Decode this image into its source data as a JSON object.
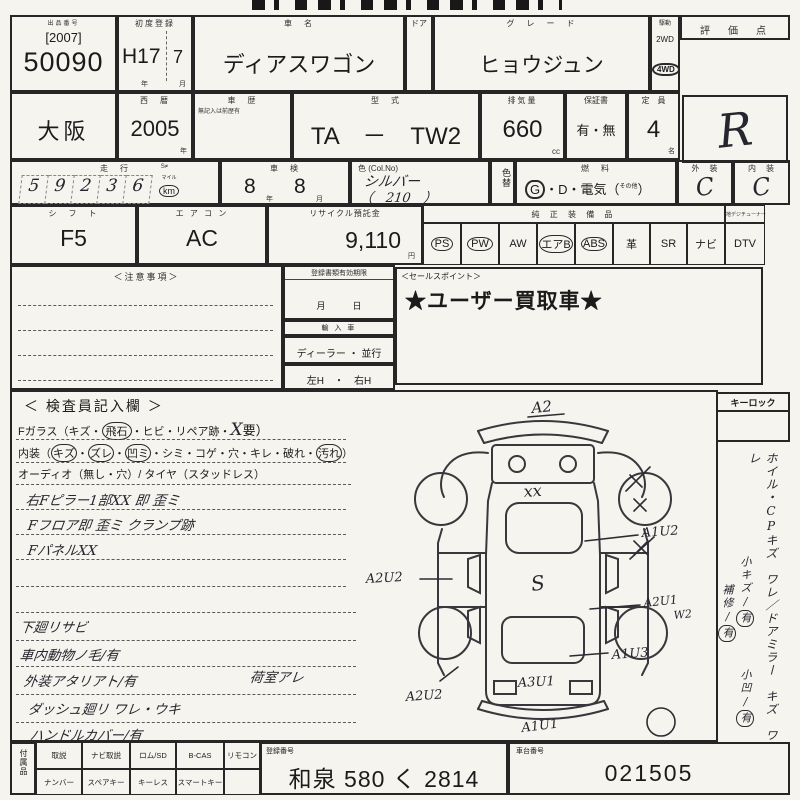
{
  "lot": {
    "label": "出品番号",
    "year": "[2007]",
    "number": "50090"
  },
  "first_reg": {
    "label": "初度登録",
    "year": "H17",
    "month": "7",
    "year_unit": "年",
    "month_unit": "月"
  },
  "car_name": {
    "label": "車　名",
    "value": "ディアスワゴン"
  },
  "door": {
    "label": "ドア"
  },
  "grade": {
    "label": "グ　レ　ー　ド",
    "value": "ヒョウジュン"
  },
  "drive": {
    "label": "駆動",
    "option1": "2WD",
    "option2": "4WD"
  },
  "score": {
    "label": "評　価　点",
    "value": "R"
  },
  "region": {
    "value": "大阪"
  },
  "west_year": {
    "label": "西　暦",
    "value": "2005",
    "unit": "年"
  },
  "history": {
    "label": "車　歴",
    "note": "無記入は前歴有"
  },
  "model": {
    "label": "型　式",
    "value": "TA　－　TW2"
  },
  "displacement": {
    "label": "排気量",
    "value": "660",
    "unit": "cc"
  },
  "warranty": {
    "label": "保証書",
    "value": "有・無"
  },
  "capacity": {
    "label": "定　員",
    "value": "4",
    "unit": "名"
  },
  "mileage": {
    "label": "走　行",
    "flag": "S≠",
    "value": "59236",
    "digits": [
      "5",
      "9",
      "2",
      "3",
      "6"
    ],
    "unit_top": "マイル",
    "unit": "km"
  },
  "shaken": {
    "label": "車　検",
    "year": "8",
    "year_unit": "年",
    "month": "8",
    "month_unit": "月"
  },
  "color": {
    "label": "色 (Col.No)",
    "value": "シルバー",
    "code": "（　210　）",
    "change_label": "色替"
  },
  "fuel": {
    "label": "燃　料",
    "g": "G",
    "rest": "・D・電気（",
    "other": "その他",
    "close": "）"
  },
  "exterior": {
    "label": "外　装",
    "value": "C"
  },
  "interior": {
    "label": "内　装",
    "value": "C"
  },
  "shift": {
    "label": "シ　フ　ト",
    "value": "F5"
  },
  "aircon": {
    "label": "エ ア コ ン",
    "value": "AC"
  },
  "recycle": {
    "label": "リサイクル預託金",
    "value": "9,110",
    "unit": "円"
  },
  "equipment": {
    "label": "純 正 装 備 品",
    "tuner_label": "地デジチューナー",
    "items": [
      {
        "name": "PS",
        "circled": true
      },
      {
        "name": "PW",
        "circled": true
      },
      {
        "name": "AW",
        "circled": false
      },
      {
        "name": "エアB",
        "circled": true
      },
      {
        "name": "ABS",
        "circled": true
      },
      {
        "name": "革",
        "circled": false
      },
      {
        "name": "SR",
        "circled": false
      },
      {
        "name": "ナビ",
        "circled": false
      },
      {
        "name": "DTV",
        "circled": false
      }
    ]
  },
  "notes_box": {
    "label": "＜注意事項＞"
  },
  "validity": {
    "label": "登録書類有効期限",
    "units": "月　　　日"
  },
  "import_car": {
    "label": "輸 入 車"
  },
  "dealer": {
    "label": "ディーラー ・ 並行"
  },
  "handle": {
    "label": "左H　・　右H"
  },
  "sales": {
    "label": "＜セールスポイント＞",
    "value": "★ユーザー買取車★"
  },
  "inspector": {
    "title": "＜ 検査員記入欄 ＞",
    "glass": {
      "prefix": "Fガラス（キズ・",
      "circled": "飛石",
      "middle": "・ヒビ・リペア跡・",
      "mark": "X",
      "suffix": "要）"
    },
    "interior_line": {
      "prefix": "内装（",
      "c1": "キズ",
      "s1": "・",
      "c2": "ズレ",
      "s2": "・",
      "c3": "凹ミ",
      "mid": "・シミ・コゲ・穴・キレ・破れ・",
      "c4": "汚れ",
      "suffix": "）"
    },
    "audio_line": "オーディオ（無し・穴）/ タイヤ（スタッドレス）",
    "notes": [
      "右Fピラー1部XX 即 歪ミ",
      "Fフロア即 歪ミ クランプ跡",
      "FパネルXX",
      "下廻リサビ",
      "車内動物ノ毛/有",
      "外装アタリアト/有",
      "ダッシュ廻リ ワレ・ウキ",
      "ハンドルカバー/有"
    ],
    "cargo_note": "荷室アレ"
  },
  "diagram": {
    "front": "A2",
    "hood": "xx",
    "center": "S",
    "rear": "A3U1",
    "bottom": "A1U1",
    "right1": "A1U2",
    "right2": "A2U1",
    "right2b": "W2",
    "right3": "A1U3",
    "left1": "A2U2",
    "left2": "A2U2"
  },
  "side": {
    "keylock": "キーロック",
    "main_note": "ホイル・CPキズ　ワレ／ドアミラー　キズ　ワレ",
    "sub1_label": "小キズ/",
    "sub1_mark": "有",
    "sub2_label": "小凹/",
    "sub2_mark": "有",
    "sub3_label": "補修/",
    "sub3_mark": "有"
  },
  "bottom": {
    "acc_label": "付属品",
    "row1": [
      "取説",
      "ナビ取説",
      "ロム/SD",
      "B-CAS",
      "リモコン"
    ],
    "row2": [
      "ナンバー",
      "スペアキー",
      "キーレス",
      "スマートキー",
      ""
    ],
    "reg": {
      "label": "登録番号",
      "value": "和泉 580 く 2814"
    },
    "chassis": {
      "label": "車台番号",
      "value": "021505"
    }
  }
}
